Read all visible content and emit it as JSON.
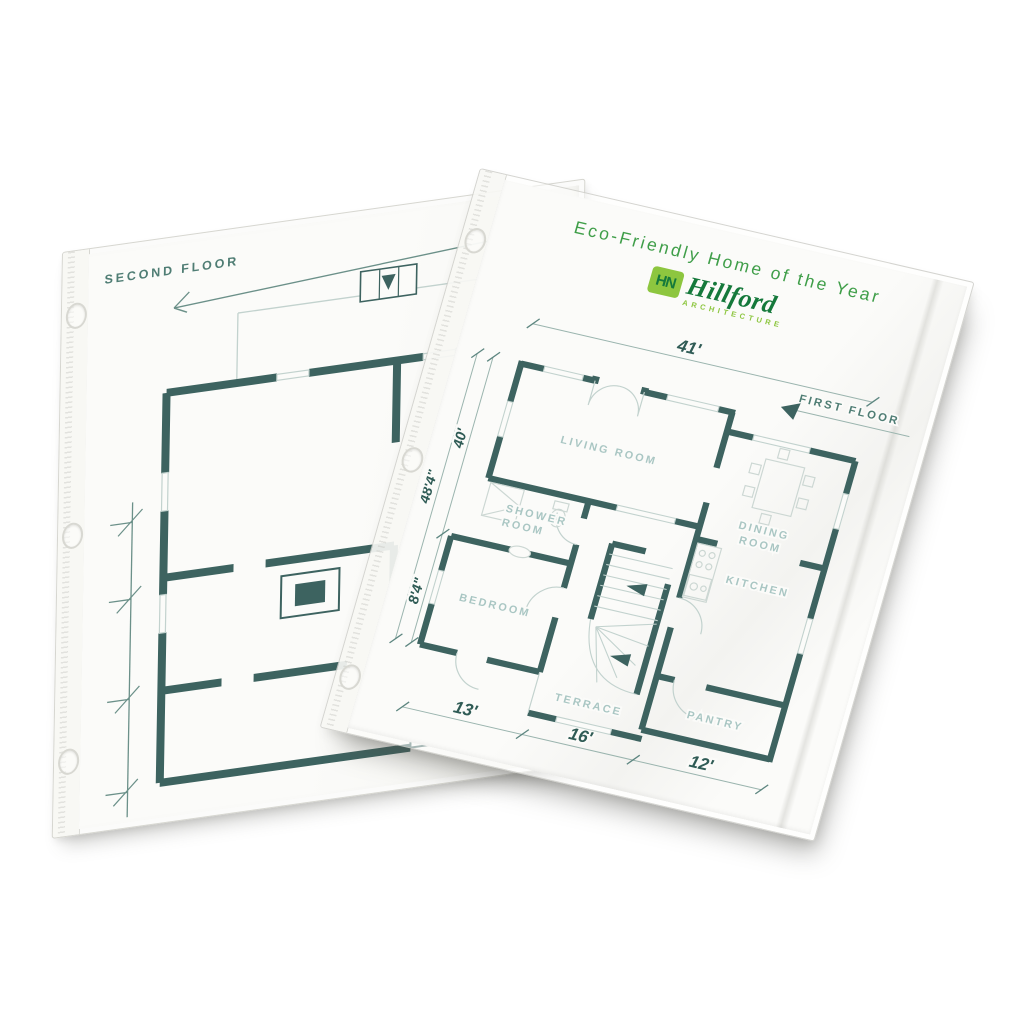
{
  "back_sheet": {
    "floor_label": "SECOND FLOOR"
  },
  "front_sheet": {
    "title": "Eco-Friendly Home of the Year",
    "logo": {
      "monogram": "HN",
      "name": "Hillford",
      "subtitle": "ARCHITECTURE"
    },
    "floor_label": "FIRST FLOOR",
    "rooms": {
      "living": "LIVING ROOM",
      "shower_1": "SHOWER",
      "shower_2": "ROOM",
      "bedroom": "BEDROOM",
      "dining_1": "DINING",
      "dining_2": "ROOM",
      "kitchen": "KITCHEN",
      "pantry": "PANTRY",
      "terrace": "TERRACE"
    },
    "dimensions": {
      "top": "41'",
      "left_outer": "48'4\"",
      "left_mid": "40'",
      "left_lower": "8'4\"",
      "bottom_left": "13'",
      "bottom_middle": "16'",
      "bottom_right": "12'"
    }
  },
  "colors": {
    "wall": "#3d6360",
    "thin_line": "#c2d2ce",
    "furniture": "#ccd7d3",
    "room_label": "#a9c6c3",
    "dimension_text": "#2f5b55",
    "dimension_line": "#9ab4ae",
    "floor_label_text": "#4f7d74",
    "title_green": "#3f9e49",
    "logo_dark_green": "#15793b",
    "logo_lime": "#8dc63f",
    "paper": "#fbfbf9"
  }
}
